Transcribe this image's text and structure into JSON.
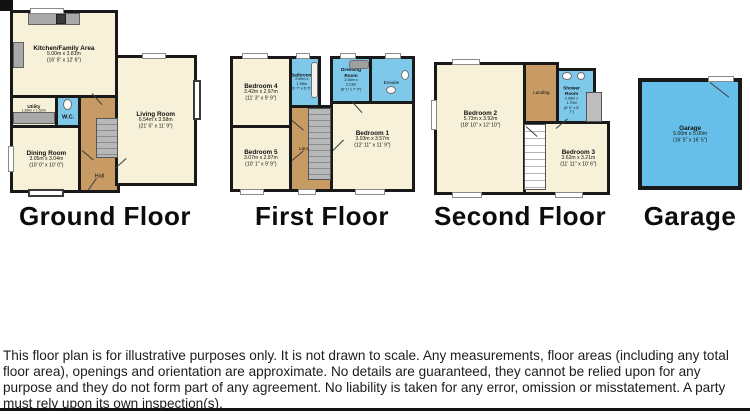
{
  "frame": {
    "disclaimer": "This floor plan is for illustrative purposes only. It is not drawn to scale. Any measurements, floor areas (including any total floor area), openings and orientation are approximate. No details are guaranteed, they cannot be relied upon for any purpose and they do not form part of any agreement. No liability is taken for any error, omission or misstatement. A party must rely upon its own inspection(s).",
    "powered_by": "Powered by www.focalagent.com"
  },
  "colors": {
    "room_cream": "#F6F1D8",
    "wet_room_blue": "#7EC8EA",
    "garage_blue": "#66BFE8",
    "hall_tan": "#C79B63",
    "wall_black": "#1A1A1A"
  },
  "floors": {
    "ground": {
      "label": "Ground Floor",
      "rooms": {
        "kitchen": {
          "name": "Kitchen/Family Area",
          "metric": "5.00m x 3.81m",
          "imperial": "(16' 5\" x 12' 6\")"
        },
        "living": {
          "name": "Living Room",
          "metric": "6.54m x 3.58m",
          "imperial": "(21' 5\" x 11' 9\")"
        },
        "dining": {
          "name": "Dining Room",
          "metric": "3.05m x 3.04m",
          "imperial": "(10' 0\" x 10' 0\")"
        },
        "utility": {
          "name": "Utility",
          "metric": "1.86m x 1.52m",
          "imperial": "(6' 1\" x 5' 0\")"
        },
        "wc": {
          "name": "W.C."
        },
        "hall": {
          "name": "Hall"
        }
      }
    },
    "first": {
      "label": "First Floor",
      "rooms": {
        "bedroom4": {
          "name": "Bedroom 4",
          "metric": "3.42m x 2.97m",
          "imperial": "(11' 3\" x 9' 9\")"
        },
        "bedroom5": {
          "name": "Bedroom 5",
          "metric": "3.07m x 2.97m",
          "imperial": "(10' 1\" x 9' 9\")"
        },
        "bedroom1": {
          "name": "Bedroom 1",
          "metric": "3.93m x 3.57m",
          "imperial": "(12' 11\" x 11' 9\")"
        },
        "bathroom": {
          "name": "Bathroom",
          "metric": "2.00m x 1.98m",
          "imperial": "(6' 7\" x 6' 6\")"
        },
        "dressing": {
          "name": "Dressing Room",
          "metric": "2.46m x 2.13m",
          "imperial": "(8' 1\" x 7' 0\")"
        },
        "ensuite": {
          "name": "Ensuite"
        },
        "landing": {
          "name": "Landing"
        }
      }
    },
    "second": {
      "label": "Second Floor",
      "rooms": {
        "bedroom2": {
          "name": "Bedroom 2",
          "metric": "5.73m x 3.92m",
          "imperial": "(18' 10\" x 12' 10\")"
        },
        "bedroom3": {
          "name": "Bedroom 3",
          "metric": "3.62m x 3.21m",
          "imperial": "(11' 11\" x 10' 6\")"
        },
        "shower": {
          "name": "Shower Room",
          "metric": "2.06m x 1.70m",
          "imperial": "(6' 9\" x 5' 7\")"
        },
        "landing": {
          "name": "Landing"
        }
      }
    },
    "garage": {
      "label": "Garage",
      "rooms": {
        "garage": {
          "name": "Garage",
          "metric": "5.00m x 5.00m",
          "imperial": "(16' 5\" x 16' 5\")"
        }
      }
    }
  }
}
